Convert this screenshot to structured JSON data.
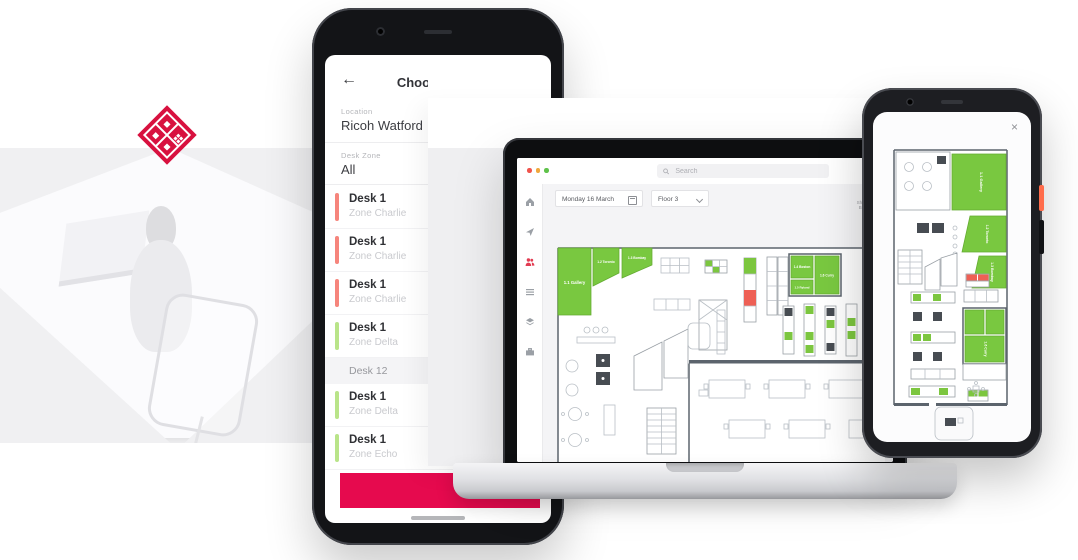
{
  "hero": {
    "logo_color": "#d8113f"
  },
  "phone_left": {
    "header": {
      "back_icon": "←",
      "title": "Choose Desk"
    },
    "location_field": {
      "label": "Location",
      "value": "Ricoh Watford"
    },
    "zone_field": {
      "label": "Desk Zone",
      "value": "All"
    },
    "desk_list": [
      {
        "type": "card",
        "name": "Desk 1",
        "zone": "Zone Charlie",
        "color": "#f6857c"
      },
      {
        "type": "card",
        "name": "Desk 1",
        "zone": "Zone Charlie",
        "color": "#f6857c"
      },
      {
        "type": "card",
        "name": "Desk 1",
        "zone": "Zone Charlie",
        "color": "#f6857c"
      },
      {
        "type": "card",
        "name": "Desk 1",
        "zone": "Zone Delta",
        "color": "#b9e489"
      },
      {
        "type": "section",
        "name": "Desk 12"
      },
      {
        "type": "card",
        "name": "Desk 1",
        "zone": "Zone Delta",
        "color": "#b9e489"
      },
      {
        "type": "card",
        "name": "Desk 1",
        "zone": "Zone Echo",
        "color": "#b9e489"
      }
    ],
    "cta_color": "#e60a4e"
  },
  "laptop": {
    "window_dots": [
      {
        "color": "#f0544c"
      },
      {
        "color": "#f0a73c"
      },
      {
        "color": "#5fc24a"
      }
    ],
    "search": {
      "placeholder": "Search"
    },
    "toolbar": {
      "date": "Monday 16 March",
      "floor": "Floor 3",
      "action_line1": "Show Desk",
      "action_line2": "Bookings"
    },
    "sidebar": {
      "icons": [
        "home",
        "navigate",
        "people",
        "bookings",
        "floors",
        "visitors"
      ],
      "active": "people",
      "active_color": "#e23c52"
    },
    "floorplan": {
      "rooms": [
        {
          "label": "1.1 Gallery"
        },
        {
          "label": "1.2 Toronto"
        },
        {
          "label": "1.3 Bombay"
        },
        {
          "label": "1.4 Boston"
        },
        {
          "label": "1.5 Ryland"
        },
        {
          "label": "1.6 Curry"
        }
      ],
      "legend": {
        "room_available": "#79c840",
        "desk_available": "#7cc63f",
        "desk_booked": "#ee6055",
        "desk_occupied": "#474c52"
      }
    }
  },
  "phone_right": {
    "close_icon": "×"
  }
}
